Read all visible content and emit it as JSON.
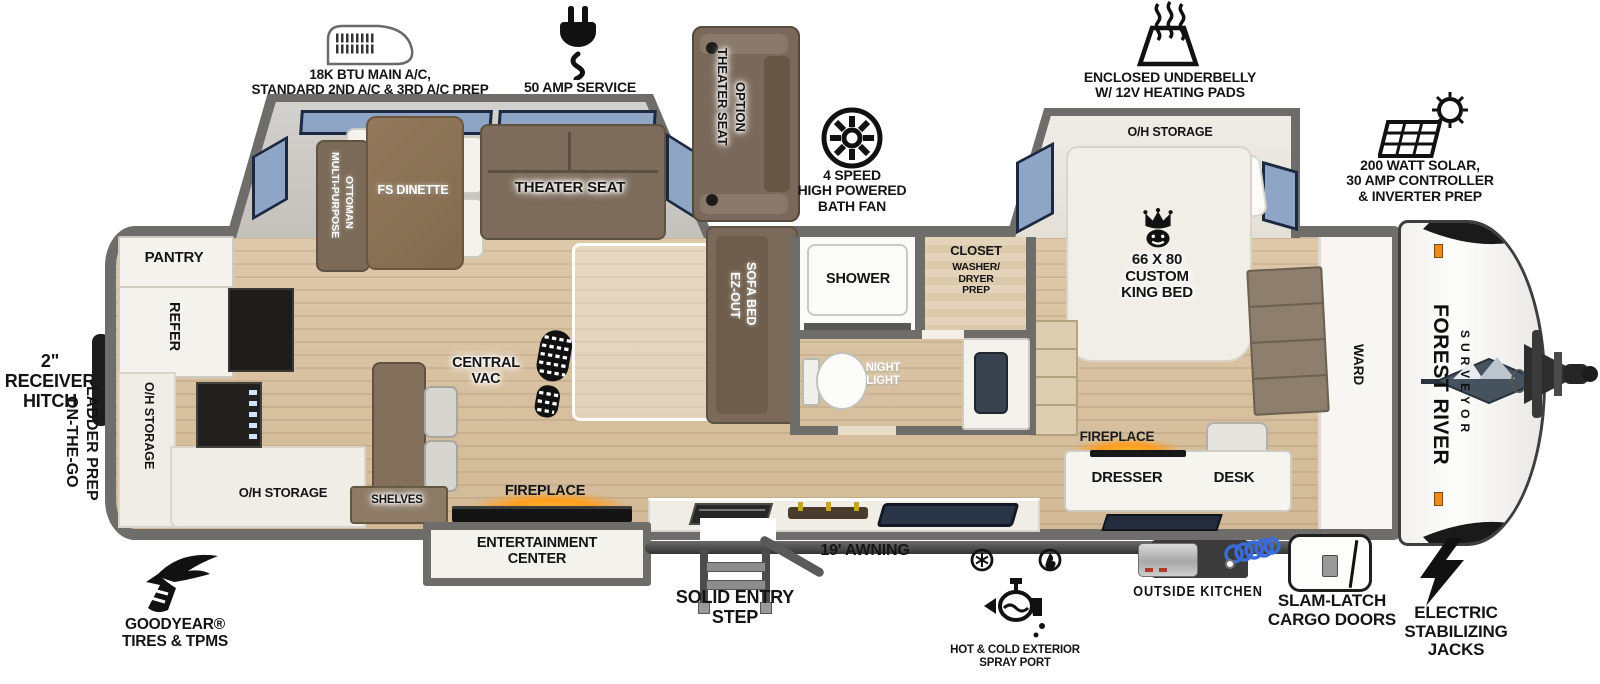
{
  "callouts": {
    "ac_unit": {
      "label": "18K BTU MAIN A/C,\nSTANDARD 2ND A/C & 3RD A/C PREP"
    },
    "amp_service": {
      "label": "50 AMP SERVICE"
    },
    "theater_option": {
      "lines": [
        "THEATER SEAT",
        "OPTION"
      ]
    },
    "bath_fan": {
      "label": "4 SPEED\nHIGH POWERED\nBATH FAN"
    },
    "underbelly": {
      "label": "ENCLOSED UNDERBELLY\nW/ 12V HEATING PADS"
    },
    "solar": {
      "label": "200 WATT SOLAR,\n30 AMP CONTROLLER\n& INVERTER PREP"
    },
    "receiver_hitch": {
      "label": "2\" RECEIVER\nHITCH"
    },
    "ladder_prep": {
      "lines": [
        "ON-THE-GO",
        "LADDER PREP"
      ]
    },
    "goodyear": {
      "label": "GOODYEAR®\nTIRES & TPMS"
    },
    "entry_step": {
      "label": "SOLID ENTRY\nSTEP"
    },
    "awning": {
      "label": "19' AWNING"
    },
    "spray_port": {
      "label": "HOT & COLD EXTERIOR\nSPRAY PORT"
    },
    "outside_kitchen": {
      "label": "OUTSIDE KITCHEN"
    },
    "cargo_doors": {
      "label": "SLAM-LATCH\nCARGO DOORS"
    },
    "stab_jacks": {
      "label": "ELECTRIC\nSTABILIZING\nJACKS"
    }
  },
  "rooms": {
    "pantry": "PANTRY",
    "refer": "REFER",
    "oh_storage_rear_wall": "O/H STORAGE",
    "oh_storage_rear_counter": "O/H STORAGE",
    "shelves": "SHELVES",
    "ottoman_lines": [
      "MULTI-PURPOSE",
      "OTTOMAN"
    ],
    "dinette": "FS DINETTE",
    "theater_seat": "THEATER SEAT",
    "sofa_bed_lines": [
      "EZ-OUT",
      "SOFA BED"
    ],
    "central_vac": "CENTRAL\nVAC",
    "shower": "SHOWER",
    "night_light": "NIGHT\nLIGHT",
    "closet": "CLOSET",
    "closet_sub": "WASHER/\nDRYER\nPREP",
    "oh_storage_bedroom": "O/H STORAGE",
    "king_bed": "66 X 80\nCUSTOM\nKING BED",
    "ward": "WARD",
    "fireplace_bedroom": "FIREPLACE",
    "dresser": "DRESSER",
    "desk": "DESK",
    "fireplace_living": "FIREPLACE",
    "entertainment": "ENTERTAINMENT\nCENTER"
  },
  "brand": {
    "name": "FOREST RIVER",
    "model": "SURVEYOR"
  },
  "colors": {
    "wall": "#6f6d6a",
    "wood_floor": "#d8c2a2",
    "window_blue": "#8ea5c6",
    "furniture_brown": "#7e6c5a",
    "fireplace_orange": "#ff9d1e"
  }
}
